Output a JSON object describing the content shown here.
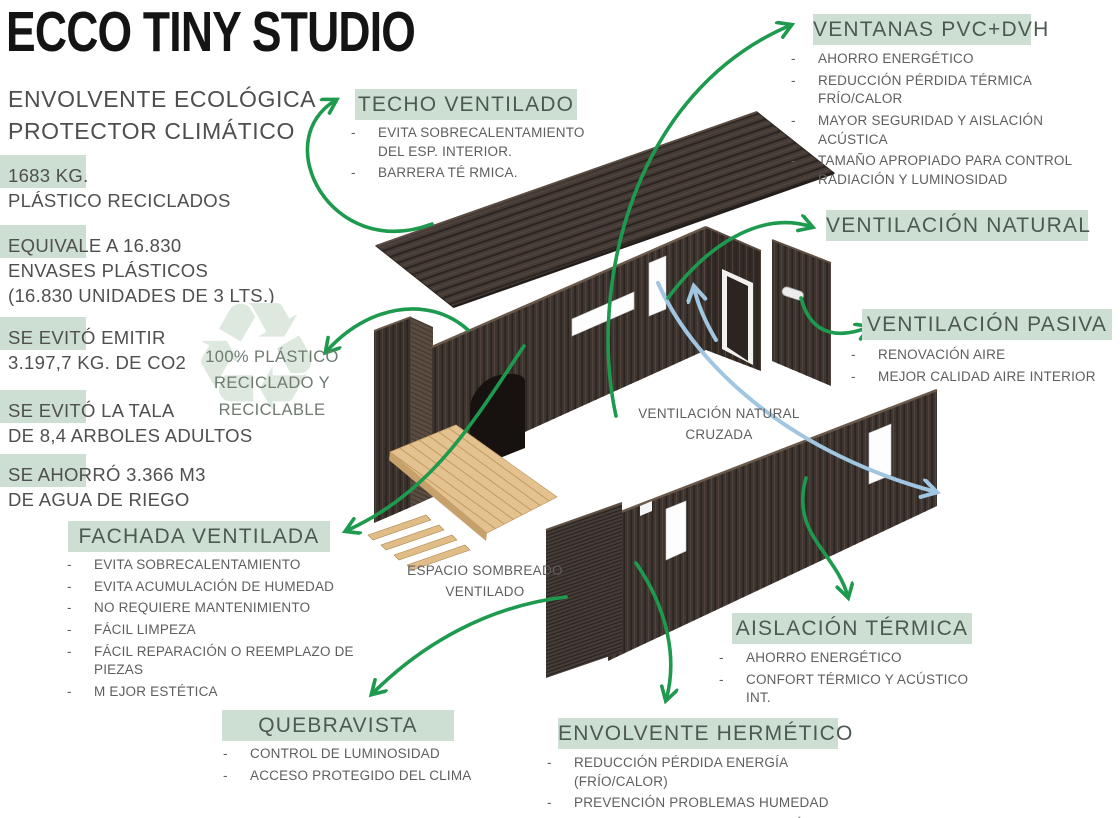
{
  "header": {
    "title": "ECCO TINY STUDIO",
    "subtitle1": "ENVOLVENTE ECOLÓGICA",
    "subtitle2": "PROTECTOR CLIMÁTICO"
  },
  "stats": [
    {
      "l1": "1683 KG.",
      "l2": "PLÁSTICO RECICLADOS"
    },
    {
      "l1": "EQUIVALE A 16.830",
      "l2": "ENVASES PLÁSTICOS",
      "l3": "(16.830 UNIDADES DE 3 LTS.)"
    },
    {
      "l1": "SE EVITÓ EMITIR",
      "l2": "3.197,7 KG. DE CO2"
    },
    {
      "l1": "SE EVITÓ LA TALA",
      "l2": "DE 8,4 ARBOLES ADULTOS"
    },
    {
      "l1": "SE AHORRÓ 3.366 M3",
      "l2": "DE AGUA DE RIEGO"
    }
  ],
  "recycle": {
    "icon": "recycle-icon",
    "line1": "100% PLÁSTICO",
    "line2": "RECICLADO Y",
    "line3": "RECICLABLE"
  },
  "callouts": {
    "techo": {
      "title": "TECHO VENTILADO",
      "bullets": [
        "EVITA SOBRECALENTAMIENTO DEL ESP. INTERIOR.",
        "BARRERA TÉ RMICA."
      ]
    },
    "ventanas": {
      "title": "VENTANAS PVC+DVH",
      "bullets": [
        "AHORRO ENERGÉTICO",
        "REDUCCIÓN PÉRDIDA TÉRMICA FRÍO/CALOR",
        "MAYOR SEGURIDAD Y AISLACIÓN ACÚSTICA",
        "TAMAÑO APROPIADO PARA CONTROL RADIACIÓN Y LUMINOSIDAD"
      ]
    },
    "vent_natural": {
      "title": "VENTILACIÓN NATURAL",
      "bullets": []
    },
    "vent_pasiva": {
      "title": "VENTILACIÓN PASIVA",
      "bullets": [
        "RENOVACIÓN AIRE",
        "MEJOR CALIDAD AIRE INTERIOR"
      ]
    },
    "fachada": {
      "title": "FACHADA VENTILADA",
      "bullets": [
        "EVITA SOBRECALENTAMIENTO",
        "EVITA ACUMULACIÓN DE HUMEDAD",
        "NO REQUIERE MANTENIMIENTO",
        "FÁCIL LIMPEZA",
        "FÁCIL REPARACIÓN O REEMPLAZO DE PIEZAS",
        "M EJOR ESTÉTICA"
      ]
    },
    "quebravista": {
      "title": "QUEBRAVISTA",
      "bullets": [
        "CONTROL DE LUMINOSIDAD",
        "ACCESO PROTEGIDO DEL CLIMA"
      ]
    },
    "envolvente": {
      "title": "ENVOLVENTE HERMÉTICO",
      "bullets": [
        "REDUCCIÓN PÉRDIDA ENERGÍA (FRÍO/CALOR)",
        "PREVENCIÓN PROBLEMAS HUMEDAD",
        "MAYOR EFICIENCIA CLIMATIZACIÓN ASISTIDA"
      ]
    },
    "aislacion": {
      "title": "AISLACIÓN TÉRMICA",
      "bullets": [
        "AHORRO ENERGÉTICO",
        "CONFORT TÉRMICO Y ACÚSTICO INT."
      ]
    }
  },
  "notes": {
    "cruzada": "VENTILACIÓN NATURAL CRUZADA",
    "sombreado": "ESPACIO SOMBREADO VENTILADO"
  },
  "colors": {
    "highlight_green": "#cddfd3",
    "arrow_green": "#1d9a4e",
    "arrow_blue": "#a0c6e2",
    "wall_dark": "#3e3430",
    "wood_deck": "#e4c28f",
    "header_text": "#4d5850",
    "body_text": "#5e5e5e",
    "recycle_watermark": "#dde9df"
  }
}
